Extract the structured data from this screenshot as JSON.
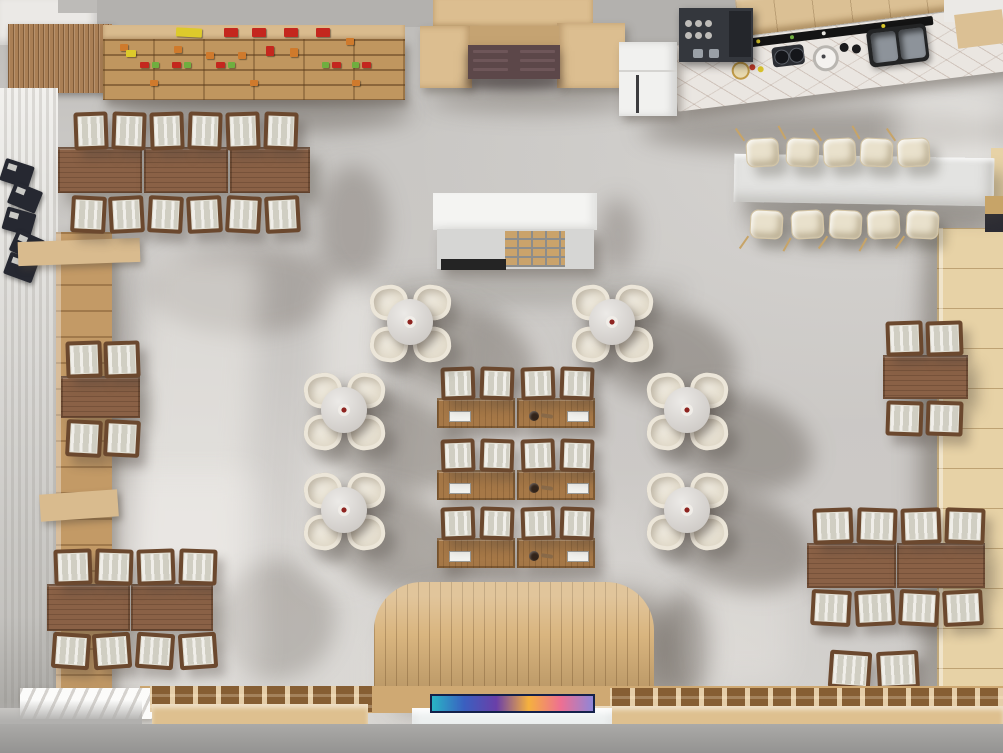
{
  "scene": {
    "description": "Top-down 3D architectural render of a cafe restaurant interior with retail shelf, entrance, coffee bar, dining areas and display counters",
    "visible_text": ""
  },
  "palette": {
    "floor": "#c9c7c4",
    "outside": "#a7a6a4",
    "wall": "#b3b1ae",
    "white_wall": "#ebe9e6",
    "slat_wood": "#aa7f55",
    "shelf_lip": "#d9bb8e",
    "shelf_face": "#c0965f",
    "portal_wood": "#dcbe90",
    "lintel": "#c5a372",
    "door": "#5c4749",
    "door_panel": "#6e5659",
    "fridge": "#f1f1ef",
    "espresso": "#34373d",
    "cabinet_wood": "#dbc094",
    "counter_marble": "#eae6e1",
    "sink": "#232425",
    "steel": "#8d939a",
    "bench": "#c39a66",
    "menu": "#262831",
    "table_wood": "#8a6146",
    "center_table_wood": "#a67847",
    "chair_frame": "#6b482e",
    "cushion": "#e2e0d5",
    "cream_chair": "#ece6d9",
    "round_marble": "#dcd9d5",
    "white_table": "#e3e3e1",
    "stool": "#e9e1cc",
    "stool_leg": "#c7a468",
    "right_shelf": "#e7d2a6",
    "platform": "#d9b57f",
    "counter_front": "#dec08f",
    "grid_counter": "#c59a63",
    "plate_red": "#8e2420",
    "product_red": "#c4271e",
    "product_yellow": "#ddca2b",
    "product_green": "#6fae3f",
    "product_orange": "#cf7a2c"
  },
  "screen_gradient": [
    "#29b4c6",
    "#3a5fc0",
    "#6a3fa8",
    "#f5b13e",
    "#ee6f92",
    "#8f86d8"
  ],
  "inventory": {
    "round_dining_sets": 6,
    "seats_per_round_set": 4,
    "left_window_tables": 3,
    "left_window_chairs": 12,
    "left_wall_small_tables": 1,
    "left_wall_small_chairs": 4,
    "left_south_tables": 2,
    "left_south_chairs": 8,
    "center_two_seat_tables": 6,
    "center_chairs": 12,
    "communal_tables": 1,
    "communal_table_stools": 10,
    "right_wall_tables": 1,
    "right_wall_chairs": 4,
    "right_south_tables": 2,
    "right_south_chairs": 8,
    "spare_chairs": 2,
    "entrance_door_leaves": 2,
    "sink_basins": 2,
    "display_counters": 3,
    "media_screens": 1
  }
}
